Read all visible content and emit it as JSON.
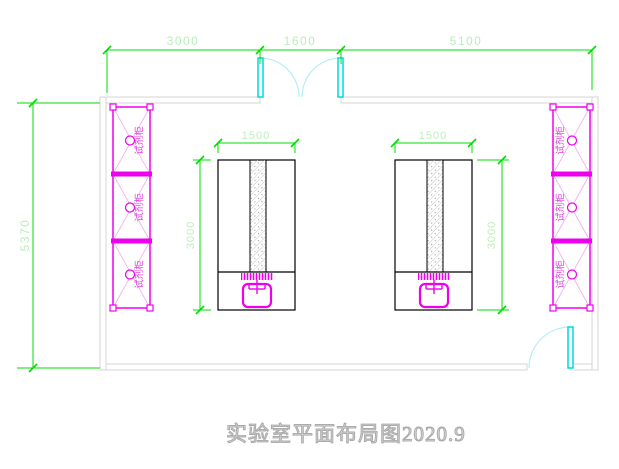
{
  "title": {
    "text": "实验室平面布局图2020.9"
  },
  "dims": {
    "top": {
      "segments": [
        {
          "label": "3000"
        },
        {
          "label": "1600"
        },
        {
          "label": "5100"
        }
      ]
    },
    "left": {
      "label": "5370"
    },
    "bench_left": {
      "width": "1500",
      "depth": "3000"
    },
    "bench_right": {
      "width": "1500",
      "depth": "3000"
    }
  },
  "cabinets": {
    "left": [
      {
        "label": "试剂柜"
      },
      {
        "label": "试剂柜"
      },
      {
        "label": "试剂柜"
      }
    ],
    "right": [
      {
        "label": "试剂柜"
      },
      {
        "label": "试剂柜"
      },
      {
        "label": "试剂柜"
      }
    ]
  },
  "colors": {
    "dimension_line": "#00dd00",
    "dimension_text": "#b9edb9",
    "wall": "#d4d4d4",
    "cabinet": "#ee00ee",
    "cabinet_brace": "#f3a8f3",
    "door_leaf": "#00d8d8",
    "door_arc": "#b5eef5",
    "bench_outline": "#000000",
    "title_text": "#c9c9c9"
  }
}
